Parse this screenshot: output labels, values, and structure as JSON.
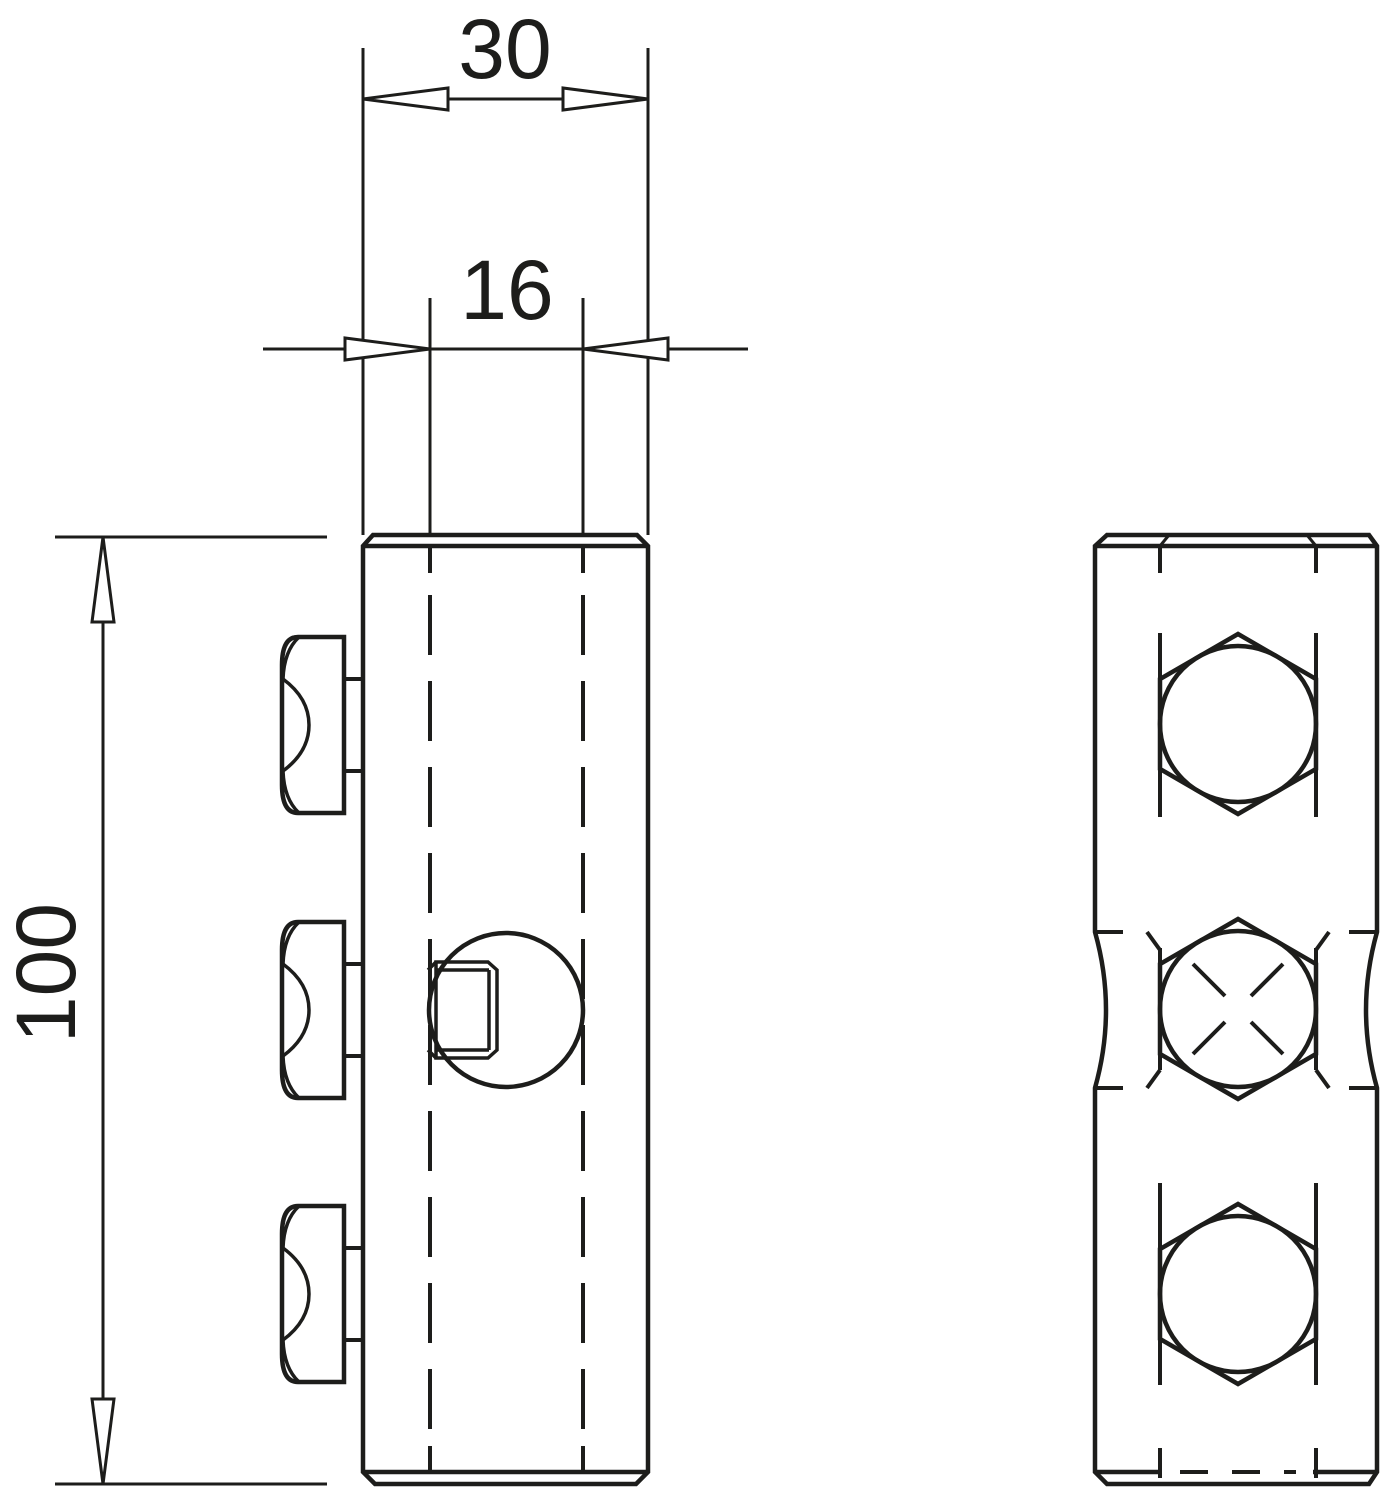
{
  "drawing": {
    "type": "technical-dimension-drawing",
    "background_color": "#ffffff",
    "line_color": "#1d1d1b",
    "dimensions": {
      "body_width": {
        "value": "30"
      },
      "slot_width": {
        "value": "16"
      },
      "body_height": {
        "value": "100"
      }
    },
    "views": {
      "front_view": {
        "description": "side view of connector body with three hex screws",
        "bolt_count": 3
      },
      "side_view": {
        "description": "face view with three hex screw heads, middle one marked with cross",
        "hex_count": 3
      }
    }
  }
}
